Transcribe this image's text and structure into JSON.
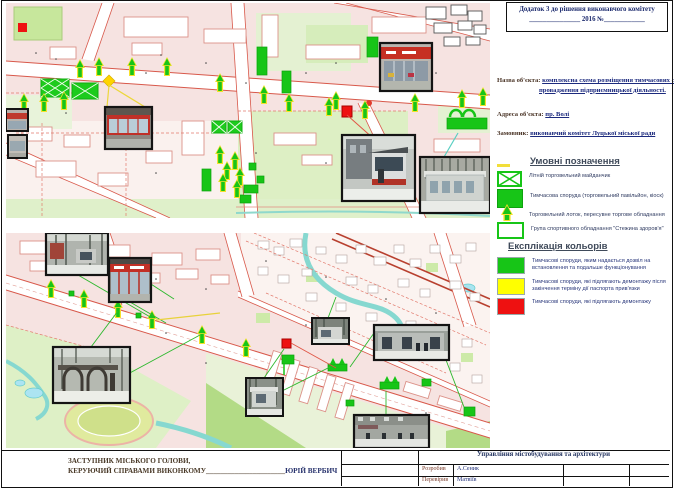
{
  "document": {
    "annex_note_line1": "Додаток 3 до рішення виконавчого комітету",
    "annex_note_line2": "_______________ 2016  №____________"
  },
  "object_info": {
    "name_label": "Назва об'єкта:",
    "name_value": "комплексна схема розміщення тимчасових споруд для провадження підприємницької діяльності.",
    "address_label": "Адреса об'єкта:",
    "address_value": "пр. Волі",
    "client_label": "Замовник:",
    "client_value": "виконавчий комітет Луцької міської ради"
  },
  "legend": {
    "title": "Умовні позначення",
    "items": [
      {
        "icon": "summer-trade-ground-icon",
        "label": "Літній торговельний майданчик"
      },
      {
        "icon": "temporary-structure-icon",
        "label": "Тимчасова споруда (торговельний павільйон, кіоск)"
      },
      {
        "icon": "trade-tray-arrow-icon",
        "label": "Торговельний лоток, пересувне торгове обладнання"
      },
      {
        "icon": "sport-equipment-icon",
        "label": "Група спортивного обладнання \"Стежина здоров'я\""
      }
    ]
  },
  "color_key": {
    "title": "Експлікація кольорів",
    "items": [
      {
        "color": "#17c517",
        "label": "Тимчасові споруди, яким надається дозвіл на встановлення та подальше функціонування"
      },
      {
        "color": "#ffff00",
        "label": "Тимчасові споруди, які підлягають демонтажу після закінчення терміну дії паспорта прив'язки"
      },
      {
        "color": "#ee1111",
        "label": "Тимчасові споруди, які підлягають демонтажу"
      }
    ]
  },
  "signature": {
    "line1": "ЗАСТУПНИК МІСЬКОГО ГОЛОВИ,",
    "line2_label": "КЕРУЮЧИЙ СПРАВАМИ ВИКОНКОМУ",
    "line2_blank": "______________________",
    "line2_name": "ЮРІЙ ВЕРБИЧ"
  },
  "titleblock": {
    "department": "Управління містобудування та архітектури",
    "rows": [
      {
        "role": "Розробив",
        "name": "А.Сеник"
      },
      {
        "role": "Перевірив",
        "name": "Матвіїв"
      }
    ]
  },
  "map_colors": {
    "background": "#f6e3e1",
    "park_green": "#ddefc4",
    "road_red": "#d8584a",
    "water_teal": "#86d8d0",
    "marker_green": "#17c517",
    "marker_yellow": "#f6e12d",
    "marker_red": "#ee1111"
  }
}
